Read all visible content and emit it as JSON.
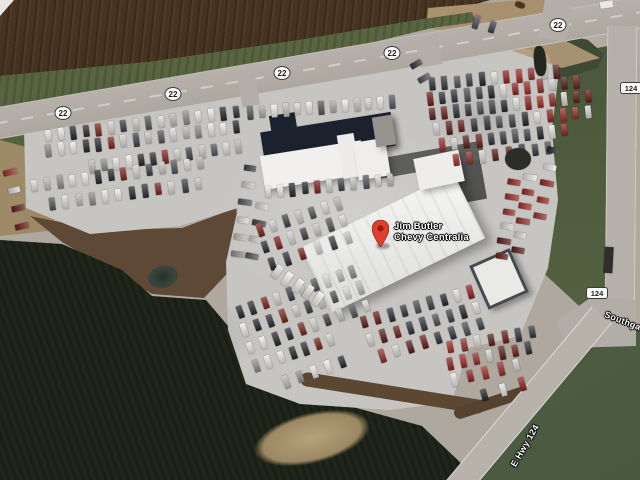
{
  "place": {
    "name_line1": "Jim Butler",
    "name_line2": "Chevy Centralia"
  },
  "marker": {
    "x": 380,
    "y": 246,
    "color": "#e23d2e",
    "hole_color": "#8c1d12"
  },
  "shields": [
    {
      "kind": "circle",
      "label": "22",
      "x": 63,
      "y": 113
    },
    {
      "kind": "circle",
      "label": "22",
      "x": 173,
      "y": 94
    },
    {
      "kind": "circle",
      "label": "22",
      "x": 282,
      "y": 73
    },
    {
      "kind": "circle",
      "label": "22",
      "x": 392,
      "y": 53
    },
    {
      "kind": "circle",
      "label": "22",
      "x": 558,
      "y": 25
    },
    {
      "kind": "rect",
      "label": "124",
      "x": 631,
      "y": 88
    },
    {
      "kind": "rect",
      "label": "124",
      "x": 597,
      "y": 293
    }
  ],
  "road_labels": [
    {
      "text": "Southgate",
      "x": 605,
      "y": 309,
      "angle": 21
    },
    {
      "text": "E Hwy 124",
      "x": 513,
      "y": 461,
      "angle": -60
    }
  ],
  "colors": {
    "label_text": "#ffffff",
    "shield_bg": "#fcfcfa",
    "road": "#b3aea7",
    "asphalt_lot": "#c7c5c1",
    "field": "#3f2f1f",
    "grass": "#55623f",
    "trees": "#20261a",
    "building_white": "#f1f0ee",
    "building_dark_roof": "#1b222e"
  },
  "cars": {
    "palettes": {
      "L": [
        "#eceae6",
        "#dcdad6",
        "#c2c1bd",
        "#f1efeb",
        "#a9a8a4",
        "#55565a"
      ],
      "M": [
        "#e8e6e2",
        "#d5d3cf",
        "#bbbab6",
        "#2c2d31",
        "#53555a",
        "#efede9",
        "#3e4046",
        "#8d8c89",
        "#7c2420",
        "#dedcd8",
        "#24262c",
        "#c8c7c3"
      ],
      "D": [
        "#34353b",
        "#8e2421",
        "#6b1d1a",
        "#23252b",
        "#d8d6d2",
        "#4d4f55",
        "#a12b25",
        "#2d3039",
        "#e6e4e0",
        "#591e1b",
        "#3f4148",
        "#952e2a"
      ],
      "W": [
        "#f1f0ec",
        "#e4e2de",
        "#eceae6"
      ]
    },
    "rows": [
      [
        48,
        136,
        236,
        112,
        16,
        "M"
      ],
      [
        48,
        151,
        236,
        127,
        16,
        "M"
      ],
      [
        92,
        167,
        238,
        147,
        13,
        "M"
      ],
      [
        34,
        186,
        200,
        163,
        14,
        "M"
      ],
      [
        52,
        204,
        198,
        184,
        12,
        "M"
      ],
      [
        10,
        172,
        22,
        226,
        4,
        "D"
      ],
      [
        250,
        168,
        238,
        254,
        6,
        "M"
      ],
      [
        262,
        206,
        252,
        256,
        4,
        "M"
      ],
      [
        260,
        230,
        338,
        204,
        7,
        "M"
      ],
      [
        265,
        247,
        343,
        221,
        7,
        "M"
      ],
      [
        272,
        264,
        348,
        238,
        6,
        "M"
      ],
      [
        250,
        113,
        392,
        102,
        13,
        "L"
      ],
      [
        268,
        192,
        390,
        180,
        11,
        "M"
      ],
      [
        432,
        84,
        556,
        72,
        11,
        "D"
      ],
      [
        430,
        99,
        576,
        82,
        13,
        "D"
      ],
      [
        432,
        114,
        588,
        96,
        14,
        "D"
      ],
      [
        436,
        129,
        588,
        112,
        13,
        "D"
      ],
      [
        442,
        145,
        564,
        130,
        11,
        "D"
      ],
      [
        456,
        160,
        548,
        148,
        8,
        "D"
      ],
      [
        514,
        182,
        502,
        256,
        6,
        "D"
      ],
      [
        530,
        177,
        518,
        250,
        6,
        "D"
      ],
      [
        553,
        150,
        540,
        216,
        5,
        "D"
      ],
      [
        240,
        312,
        352,
        272,
        10,
        "M"
      ],
      [
        244,
        330,
        360,
        288,
        10,
        "M"
      ],
      [
        250,
        348,
        366,
        306,
        10,
        "M"
      ],
      [
        256,
        366,
        330,
        340,
        7,
        "M"
      ],
      [
        286,
        382,
        342,
        362,
        5,
        "M"
      ],
      [
        364,
        322,
        470,
        292,
        9,
        "D"
      ],
      [
        370,
        340,
        476,
        308,
        9,
        "D"
      ],
      [
        382,
        356,
        480,
        324,
        8,
        "D"
      ],
      [
        450,
        347,
        532,
        332,
        7,
        "D"
      ],
      [
        450,
        364,
        528,
        348,
        7,
        "D"
      ],
      [
        454,
        380,
        516,
        365,
        5,
        "D"
      ],
      [
        484,
        395,
        522,
        384,
        3,
        "D"
      ],
      [
        277,
        272,
        318,
        299,
        5,
        "W"
      ],
      [
        476,
        22,
        492,
        27,
        2,
        "D"
      ],
      [
        416,
        64,
        424,
        78,
        2,
        "D"
      ]
    ]
  },
  "vehicles": [
    {
      "x": 604,
      "y": 247,
      "w": 9,
      "h": 26,
      "a": 3,
      "c": "#2e2e2c",
      "r": 2
    },
    {
      "x": 600,
      "y": 1,
      "w": 13,
      "h": 7,
      "a": -8,
      "c": "#eae8e4",
      "r": 2
    },
    {
      "x": 534,
      "y": 46,
      "w": 12,
      "h": 30,
      "a": -5,
      "c": "#23271f",
      "r": 40
    },
    {
      "x": 505,
      "y": 148,
      "w": 26,
      "h": 22,
      "a": 0,
      "c": "#2a2e26",
      "r": 50
    },
    {
      "x": 515,
      "y": 2,
      "w": 10,
      "h": 6,
      "a": 20,
      "c": "#4a3425",
      "r": 40
    }
  ]
}
